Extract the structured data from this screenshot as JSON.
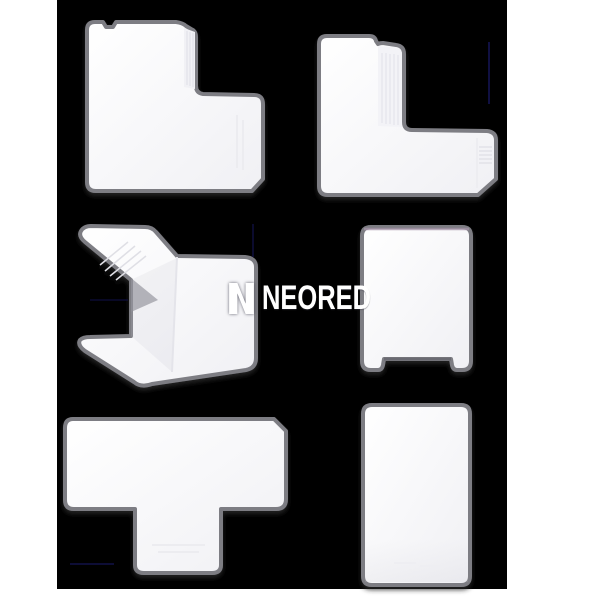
{
  "page": {
    "background_color": "#ffffff",
    "canvas_color": "#000000"
  },
  "watermark": {
    "logo_icon": "neored-n-logo",
    "text": "NEORED",
    "color": "#ffffff"
  },
  "pieces": {
    "fill_color": "#fdfdff",
    "fill_shade_color": "#f0f0f4",
    "border_color": "#7d7d83",
    "coupler_top_tint": "#a392a6",
    "items": [
      {
        "id": "flat-angle-corner-top-left"
      },
      {
        "id": "l-angle-top-right"
      },
      {
        "id": "external-corner-middle-left"
      },
      {
        "id": "coupler-middle-right"
      },
      {
        "id": "tee-bottom-left"
      },
      {
        "id": "cover-strip-bottom-right"
      }
    ]
  },
  "artifacts": {
    "line_color": "#13134d"
  }
}
